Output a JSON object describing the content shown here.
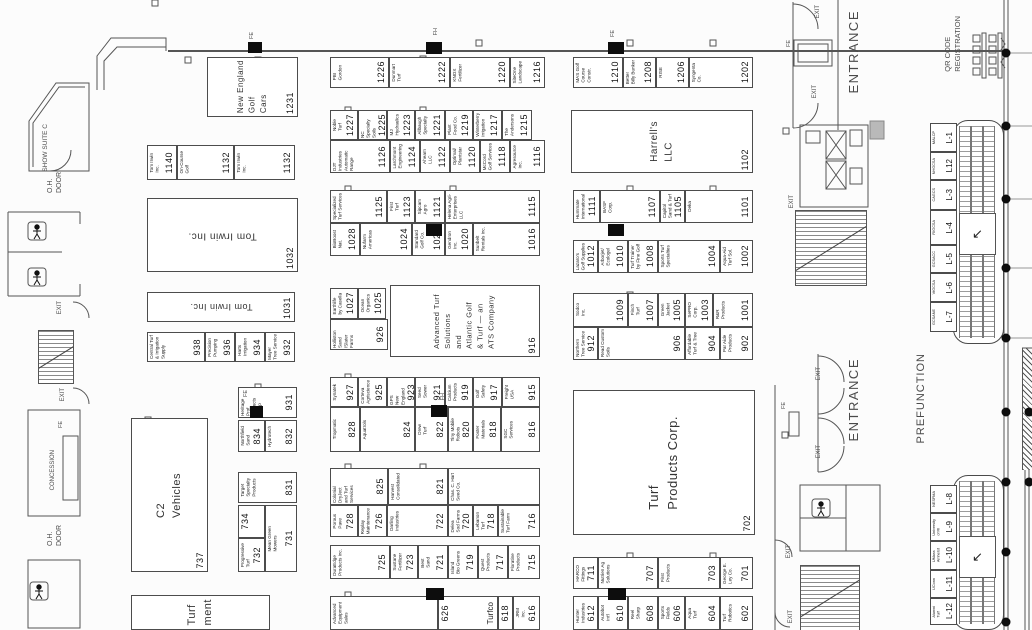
{
  "booths": [
    {
      "n": "1231",
      "t": "New England\nGolf\nCars",
      "x": 207,
      "y": 57,
      "w": 91,
      "h": 60,
      "big": 1,
      "ns": 8
    },
    {
      "n": "1226",
      "t": "PBI\nGordon",
      "x": 330,
      "y": 57,
      "w": 59,
      "h": 31
    },
    {
      "n": "1222",
      "t": "Dunmart\nTurf",
      "x": 389,
      "y": 57,
      "w": 61,
      "h": 31
    },
    {
      "n": "1220",
      "t": "KNOX\nFertilizer",
      "x": 450,
      "y": 57,
      "w": 60,
      "h": 31
    },
    {
      "n": "1216",
      "t": "SiteOne\nLandscape",
      "x": 510,
      "y": 57,
      "w": 35,
      "h": 31
    },
    {
      "n": "1210",
      "t": "MAS Golf\nCourse\nConstr.",
      "x": 573,
      "y": 57,
      "w": 50,
      "h": 31
    },
    {
      "n": "1208",
      "t": "Better\nBilly Bunker",
      "x": 623,
      "y": 57,
      "w": 33,
      "h": 31
    },
    {
      "n": "1206",
      "t": "RISE",
      "x": 656,
      "y": 57,
      "w": 33,
      "h": 31
    },
    {
      "n": "1202",
      "t": "Syngenta\nCo.",
      "x": 689,
      "y": 57,
      "w": 64,
      "h": 31
    },
    {
      "n": "1140",
      "t": "Tom Irwin\nInc.",
      "x": 147,
      "y": 145,
      "w": 30,
      "h": 35
    },
    {
      "n": "1132",
      "t": "On-Course\nGolf",
      "x": 177,
      "y": 145,
      "w": 57,
      "h": 35
    },
    {
      "n": "1132",
      "t": "Tom Irwin\nInc.",
      "x": 234,
      "y": 145,
      "w": 61,
      "h": 35
    },
    {
      "n": "1032",
      "t": "Tom Irwin Inc.",
      "x": 147,
      "y": 198,
      "w": 151,
      "h": 74,
      "big": 1,
      "flip": 1
    },
    {
      "n": "1031",
      "t": "Tom Irwin Inc.",
      "x": 147,
      "y": 292,
      "w": 148,
      "h": 30,
      "big": 1,
      "flip": 1,
      "ns": 9
    },
    {
      "n": "938",
      "t": "Central Turf\n& Irrigation\nSupply",
      "x": 147,
      "y": 332,
      "w": 58,
      "h": 30
    },
    {
      "n": "936",
      "t": "Precision\nPumping",
      "x": 205,
      "y": 332,
      "w": 30,
      "h": 30
    },
    {
      "n": "934",
      "t": "Harts\nIrrigation",
      "x": 235,
      "y": 332,
      "w": 30,
      "h": 30
    },
    {
      "n": "932",
      "t": "Mayer\nTree Service",
      "x": 265,
      "y": 332,
      "w": 30,
      "h": 30
    },
    {
      "n": "931",
      "t": "Heritage Prof.\nProducts\nGroup",
      "x": 238,
      "y": 387,
      "w": 59,
      "h": 31
    },
    {
      "n": "834",
      "t": "Northfield\nSand",
      "x": 238,
      "y": 420,
      "w": 27,
      "h": 32
    },
    {
      "n": "832",
      "t": "Hydrotech",
      "x": 265,
      "y": 420,
      "w": 32,
      "h": 32
    },
    {
      "n": "831",
      "t": "Target\nSpecialty\nProducts",
      "x": 238,
      "y": 472,
      "w": 59,
      "h": 31
    },
    {
      "n": "734",
      "t": "",
      "x": 238,
      "y": 505,
      "w": 27,
      "h": 33
    },
    {
      "n": "732",
      "t": "Progressive\nTurf",
      "x": 238,
      "y": 538,
      "w": 27,
      "h": 34
    },
    {
      "n": "731",
      "t": "Mean Green\nMowers",
      "x": 265,
      "y": 505,
      "w": 32,
      "h": 67
    },
    {
      "n": "737",
      "t": "C2\nVehicles",
      "x": 131,
      "y": 418,
      "w": 77,
      "h": 154,
      "big": 1,
      "ns": 11
    },
    {
      "n": "",
      "t": "Turf\nment",
      "x": 131,
      "y": 595,
      "w": 139,
      "h": 35,
      "big": 1,
      "ns": 11
    },
    {
      "n": "1227",
      "t": "Noble\nTurf",
      "x": 330,
      "y": 110,
      "w": 28,
      "h": 30
    },
    {
      "n": "1225",
      "t": "NC Specialty\nSoils",
      "x": 358,
      "y": 110,
      "w": 29,
      "h": 30
    },
    {
      "n": "1223",
      "t": "MJ\nHydraulics",
      "x": 387,
      "y": 110,
      "w": 28,
      "h": 30
    },
    {
      "n": "1221",
      "t": "Allbaugh\nSpecialty",
      "x": 415,
      "y": 110,
      "w": 30,
      "h": 30
    },
    {
      "n": "1219",
      "t": "Plant\nFood Co.",
      "x": 445,
      "y": 110,
      "w": 28,
      "h": 30
    },
    {
      "n": "1217",
      "t": "Winterberry\nIrrigation",
      "x": 473,
      "y": 110,
      "w": 29,
      "h": 30
    },
    {
      "n": "1215",
      "t": "The\nAndersons",
      "x": 502,
      "y": 110,
      "w": 30,
      "h": 30
    },
    {
      "n": "1126",
      "t": "DJT Industries\nAutomatic Range",
      "x": 330,
      "y": 140,
      "w": 60,
      "h": 33
    },
    {
      "n": "1124",
      "t": "Larchmont\nEngineering",
      "x": 390,
      "y": 140,
      "w": 30,
      "h": 33
    },
    {
      "n": "1122",
      "t": "Ahearn\nLLC",
      "x": 420,
      "y": 140,
      "w": 30,
      "h": 33
    },
    {
      "n": "1120",
      "t": "Optimal/\nPlantstar",
      "x": 450,
      "y": 140,
      "w": 30,
      "h": 33
    },
    {
      "n": "1118",
      "t": "McCord\nGolf Services",
      "x": 480,
      "y": 140,
      "w": 30,
      "h": 33
    },
    {
      "n": "1116",
      "t": "Agresource\nInc.",
      "x": 510,
      "y": 140,
      "w": 35,
      "h": 33
    },
    {
      "n": "1125",
      "t": "Specialized\nTurf Services",
      "x": 330,
      "y": 190,
      "w": 57,
      "h": 33
    },
    {
      "n": "1123",
      "t": "First\nTurf",
      "x": 387,
      "y": 190,
      "w": 28,
      "h": 33
    },
    {
      "n": "1121",
      "t": "Sipcam\nAgro",
      "x": 415,
      "y": 190,
      "w": 30,
      "h": 33
    },
    {
      "n": "1115",
      "t": "Helena Agri-\nEnterprises\nLLC",
      "x": 445,
      "y": 190,
      "w": 95,
      "h": 33
    },
    {
      "n": "1028",
      "t": "BioBoost\nNat.",
      "x": 330,
      "y": 223,
      "w": 30,
      "h": 33
    },
    {
      "n": "1024",
      "t": "Nufarm\nAmericas",
      "x": 360,
      "y": 223,
      "w": 52,
      "h": 33
    },
    {
      "n": "1022",
      "t": "Standard\nGolf Co.",
      "x": 412,
      "y": 223,
      "w": 33,
      "h": 33
    },
    {
      "n": "1020",
      "t": "Gendron\nInc.",
      "x": 445,
      "y": 223,
      "w": 28,
      "h": 33
    },
    {
      "n": "1016",
      "t": "Sunbelt\nRentals Inc.",
      "x": 473,
      "y": 223,
      "w": 67,
      "h": 33
    },
    {
      "n": "1027",
      "t": "Earthlife\nby Casella",
      "x": 330,
      "y": 288,
      "w": 28,
      "h": 31
    },
    {
      "n": "1025",
      "t": "Ocean\nOrganics",
      "x": 358,
      "y": 288,
      "w": 28,
      "h": 31
    },
    {
      "n": "926",
      "t": "Holliston Sand\n/Slater Farms",
      "x": 330,
      "y": 319,
      "w": 58,
      "h": 31
    },
    {
      "n": "916",
      "t": "Advanced Turf\nSolutions\nand\nAtlantic Golf\n& Turf — an\nATS Company",
      "x": 390,
      "y": 285,
      "w": 150,
      "h": 72,
      "big": 1,
      "ns": 7.5
    },
    {
      "n": "927",
      "t": "Synatek",
      "x": 330,
      "y": 377,
      "w": 28,
      "h": 30
    },
    {
      "n": "925",
      "t": "Corteva\nAgriscience",
      "x": 358,
      "y": 377,
      "w": 29,
      "h": 30
    },
    {
      "n": "923",
      "t": "GPS\nNew England",
      "x": 387,
      "y": 377,
      "w": 28,
      "h": 30
    },
    {
      "n": "921",
      "t": "Seed\nSower",
      "x": 415,
      "y": 377,
      "w": 30,
      "h": 30
    },
    {
      "n": "919",
      "t": "Calcium\nProducts",
      "x": 445,
      "y": 377,
      "w": 28,
      "h": 30
    },
    {
      "n": "917",
      "t": "Golf\nSafety",
      "x": 473,
      "y": 377,
      "w": 29,
      "h": 30
    },
    {
      "n": "915",
      "t": "Freight\nUSA",
      "x": 502,
      "y": 377,
      "w": 38,
      "h": 30
    },
    {
      "n": "828",
      "t": "Tropmatic",
      "x": 330,
      "y": 407,
      "w": 30,
      "h": 45
    },
    {
      "n": "824",
      "t": "Aquatrols",
      "x": 360,
      "y": 407,
      "w": 55,
      "h": 45
    },
    {
      "n": "822",
      "t": "Drew\nTurf",
      "x": 415,
      "y": 407,
      "w": 33,
      "h": 45
    },
    {
      "n": "820",
      "t": "Tiny Mobile\nRobots",
      "x": 448,
      "y": 407,
      "w": 25,
      "h": 45
    },
    {
      "n": "818",
      "t": "Foster\nMaterials",
      "x": 473,
      "y": 407,
      "w": 28,
      "h": 45
    },
    {
      "n": "816",
      "t": "SGC\nServices",
      "x": 501,
      "y": 407,
      "w": 39,
      "h": 45
    },
    {
      "n": "825",
      "t": "Colonial DryJect\nand Turf\nServices",
      "x": 330,
      "y": 468,
      "w": 58,
      "h": 37
    },
    {
      "n": "821",
      "t": "Harvest\nConsolidated",
      "x": 388,
      "y": 468,
      "w": 60,
      "h": 37
    },
    {
      "n": "",
      "t": "Chas. C. Hart\nSeed Co.",
      "x": 448,
      "y": 468,
      "w": 92,
      "h": 37
    },
    {
      "n": "728",
      "t": "Porous\nPave",
      "x": 330,
      "y": 505,
      "w": 28,
      "h": 32
    },
    {
      "n": "726",
      "t": "Replay\nMaintenance",
      "x": 358,
      "y": 505,
      "w": 29,
      "h": 32
    },
    {
      "n": "722",
      "t": "Darling\nIndustries",
      "x": 387,
      "y": 505,
      "w": 61,
      "h": 32
    },
    {
      "n": "720",
      "t": "Delea\nSod Farms",
      "x": 448,
      "y": 505,
      "w": 25,
      "h": 32
    },
    {
      "n": "718",
      "t": "Lebanon\nTurf",
      "x": 473,
      "y": 505,
      "w": 25,
      "h": 32
    },
    {
      "n": "716",
      "t": "Sustainable\nTurf Farm",
      "x": 498,
      "y": 505,
      "w": 42,
      "h": 32
    },
    {
      "n": "725",
      "t": "DuraEdge\nProducts Inc.",
      "x": 330,
      "y": 545,
      "w": 60,
      "h": 34
    },
    {
      "n": "723",
      "t": "Sustane\nFertilizer",
      "x": 390,
      "y": 545,
      "w": 28,
      "h": 34
    },
    {
      "n": "721",
      "t": "Best\nSand",
      "x": 418,
      "y": 545,
      "w": 30,
      "h": 34
    },
    {
      "n": "719",
      "t": "Island\nBio Greens",
      "x": 448,
      "y": 545,
      "w": 30,
      "h": 34
    },
    {
      "n": "717",
      "t": "Quest\nProducts",
      "x": 478,
      "y": 545,
      "w": 30,
      "h": 34
    },
    {
      "n": "715",
      "t": "Floratine\nProducts",
      "x": 508,
      "y": 545,
      "w": 32,
      "h": 34
    },
    {
      "n": "",
      "t": "Advanced\nEquipment\nSales",
      "x": 330,
      "y": 596,
      "w": 108,
      "h": 34
    },
    {
      "n": "626",
      "t": "Turfco",
      "x": 438,
      "y": 596,
      "w": 60,
      "h": 34,
      "rev": 1,
      "ns": 8
    },
    {
      "n": "618",
      "t": "",
      "x": 498,
      "y": 596,
      "w": 15,
      "h": 34
    },
    {
      "n": "616",
      "t": "JRM\nInc.",
      "x": 513,
      "y": 596,
      "w": 27,
      "h": 34
    },
    {
      "n": "1102",
      "t": "Harrell's\nLLC",
      "x": 571,
      "y": 110,
      "w": 182,
      "h": 63,
      "big": 1
    },
    {
      "n": "1111",
      "t": "Hummate\nInternational",
      "x": 573,
      "y": 190,
      "w": 27,
      "h": 33
    },
    {
      "n": "1107",
      "t": "BASF\nCorp.",
      "x": 600,
      "y": 190,
      "w": 60,
      "h": 33
    },
    {
      "n": "1105",
      "t": "Capitol\nSand & Turf",
      "x": 660,
      "y": 190,
      "w": 25,
      "h": 33
    },
    {
      "n": "1101",
      "t": "Deka",
      "x": 685,
      "y": 190,
      "w": 68,
      "h": 33
    },
    {
      "n": "1012",
      "t": "Lazaro's\nGolf Supplies",
      "x": 573,
      "y": 240,
      "w": 25,
      "h": 33
    },
    {
      "n": "1010",
      "t": "Arborjet/\nEcologel",
      "x": 598,
      "y": 240,
      "w": 30,
      "h": 33
    },
    {
      "n": "1008",
      "t": "Turf Trainer\nby Fine Golf",
      "x": 628,
      "y": 240,
      "w": 30,
      "h": 33
    },
    {
      "n": "1004",
      "t": "Sports Turf\nSpecialties",
      "x": 658,
      "y": 240,
      "w": 62,
      "h": 33
    },
    {
      "n": "1002",
      "t": "Aqua-Aid\nTurf Sol.",
      "x": 720,
      "y": 240,
      "w": 33,
      "h": 33
    },
    {
      "n": "1009",
      "t": "Sodco\nInc.",
      "x": 573,
      "y": 293,
      "w": 55,
      "h": 34
    },
    {
      "n": "1007",
      "t": "Finch\nTurf",
      "x": 628,
      "y": 293,
      "w": 30,
      "h": 34
    },
    {
      "n": "1005",
      "t": "Green\nJacket",
      "x": 658,
      "y": 293,
      "w": 27,
      "h": 34
    },
    {
      "n": "1003",
      "t": "SePRO\nCorp.",
      "x": 685,
      "y": 293,
      "w": 28,
      "h": 34
    },
    {
      "n": "1001",
      "t": "R&R\nProducts",
      "x": 713,
      "y": 293,
      "w": 40,
      "h": 34
    },
    {
      "n": "912",
      "t": "Northern\nTree Service",
      "x": 573,
      "y": 327,
      "w": 25,
      "h": 33
    },
    {
      "n": "906",
      "t": "Read Custom\nSoils",
      "x": 598,
      "y": 327,
      "w": 87,
      "h": 33
    },
    {
      "n": "904",
      "t": "Affordable\nTurf & Tree",
      "x": 685,
      "y": 327,
      "w": 35,
      "h": 33
    },
    {
      "n": "902",
      "t": "Par Aide\nProducts",
      "x": 720,
      "y": 327,
      "w": 33,
      "h": 33
    },
    {
      "n": "702",
      "t": "Turf\nProducts Corp.",
      "x": 573,
      "y": 390,
      "w": 182,
      "h": 145,
      "big": 1,
      "ns": 13
    },
    {
      "n": "711",
      "t": "HARCO\nFittings",
      "x": 573,
      "y": 557,
      "w": 25,
      "h": 32
    },
    {
      "n": "707",
      "t": "Nutrien Ag\nSolutions",
      "x": 598,
      "y": 557,
      "w": 60,
      "h": 32
    },
    {
      "n": "703",
      "t": "First\nProducts",
      "x": 658,
      "y": 557,
      "w": 62,
      "h": 32
    },
    {
      "n": "701",
      "t": "George E.\nLey Co.",
      "x": 720,
      "y": 557,
      "w": 33,
      "h": 32
    },
    {
      "n": "612",
      "t": "Hunter\nIndustries",
      "x": 573,
      "y": 596,
      "w": 25,
      "h": 34
    },
    {
      "n": "610",
      "t": "Autobot\nInt'l",
      "x": 598,
      "y": 596,
      "w": 30,
      "h": 34
    },
    {
      "n": "608",
      "t": "Reel\nSharp",
      "x": 628,
      "y": 596,
      "w": 30,
      "h": 34
    },
    {
      "n": "606",
      "t": "Sports\nFields",
      "x": 658,
      "y": 596,
      "w": 27,
      "h": 34
    },
    {
      "n": "604",
      "t": "Aqua\nTurf",
      "x": 685,
      "y": 596,
      "w": 35,
      "h": 34
    },
    {
      "n": "602",
      "t": "Turf\nRobotics",
      "x": 720,
      "y": 596,
      "w": 33,
      "h": 34
    },
    {
      "n": "L-1",
      "t": "MALCP",
      "x": 930,
      "y": 123,
      "w": 27,
      "h": 29,
      "cls": "lcell"
    },
    {
      "n": "L12",
      "t": "NHGCSA",
      "x": 930,
      "y": 152,
      "w": 27,
      "h": 28,
      "cls": "lcell"
    },
    {
      "n": "L-3",
      "t": "CAGCS",
      "x": 930,
      "y": 180,
      "w": 27,
      "h": 30,
      "cls": "lcell"
    },
    {
      "n": "L-4",
      "t": "RIGCSA",
      "x": 930,
      "y": 210,
      "w": 27,
      "h": 35,
      "cls": "lcell"
    },
    {
      "n": "L-5",
      "t": "GCSACC",
      "x": 930,
      "y": 245,
      "w": 27,
      "h": 28,
      "cls": "lcell"
    },
    {
      "n": "L-6",
      "t": "VtGCSA",
      "x": 930,
      "y": 273,
      "w": 27,
      "h": 29,
      "cls": "lcell"
    },
    {
      "n": "L-7",
      "t": "GCSANE",
      "x": 930,
      "y": 302,
      "w": 27,
      "h": 30,
      "cls": "lcell"
    },
    {
      "n": "L-8",
      "t": "NESFMA",
      "x": 930,
      "y": 485,
      "w": 27,
      "h": 28,
      "cls": "lcell"
    },
    {
      "n": "L-9",
      "t": "University\nof RI",
      "x": 930,
      "y": 513,
      "w": 27,
      "h": 28,
      "cls": "lcell"
    },
    {
      "n": "L-10",
      "t": "UMass\nAmherst",
      "x": 930,
      "y": 541,
      "w": 27,
      "h": 29,
      "cls": "lcell"
    },
    {
      "n": "L-11",
      "t": "UConn",
      "x": 930,
      "y": 570,
      "w": 27,
      "h": 28,
      "cls": "lcell"
    },
    {
      "n": "L-12",
      "t": "Alumni\nTurf",
      "x": 930,
      "y": 598,
      "w": 27,
      "h": 27,
      "cls": "lcell"
    }
  ],
  "labels": [
    {
      "t": "SHOW SUITE C",
      "x": 42,
      "y": 124,
      "s": 6.5
    },
    {
      "t": "O.H.\nDOOR",
      "x": 46,
      "y": 172,
      "s": 7
    },
    {
      "t": "O.H.\nDOOR",
      "x": 46,
      "y": 525,
      "s": 7
    },
    {
      "t": "CONCESSION",
      "x": 50,
      "y": 450,
      "s": 6
    },
    {
      "t": "PREFUNCTION",
      "x": 914,
      "y": 353,
      "s": 11,
      "ls": 1
    },
    {
      "t": "ENTRANCE",
      "x": 846,
      "y": 10,
      "s": 13,
      "ls": 1.5
    },
    {
      "t": "ENTRANCE",
      "x": 846,
      "y": 358,
      "s": 13,
      "ls": 1.5
    },
    {
      "t": "QR CODE\nREGISTRATION",
      "x": 943,
      "y": 16,
      "s": 7.5
    },
    {
      "t": "EXIT",
      "x": 57,
      "y": 301,
      "s": 6
    },
    {
      "t": "EXIT",
      "x": 60,
      "y": 388,
      "s": 6
    },
    {
      "t": "EXIT",
      "x": 815,
      "y": 5,
      "s": 6
    },
    {
      "t": "EXIT",
      "x": 812,
      "y": 85,
      "s": 6
    },
    {
      "t": "EXIT",
      "x": 789,
      "y": 195,
      "s": 6
    },
    {
      "t": "EXIT",
      "x": 816,
      "y": 367,
      "s": 6
    },
    {
      "t": "EXIT",
      "x": 816,
      "y": 445,
      "s": 6
    },
    {
      "t": "EXIT",
      "x": 786,
      "y": 545,
      "s": 6
    },
    {
      "t": "EXIT",
      "x": 788,
      "y": 610,
      "s": 6
    },
    {
      "t": "FE",
      "x": 249,
      "y": 32,
      "s": 5.5
    },
    {
      "t": "FE",
      "x": 610,
      "y": 30,
      "s": 5.5
    },
    {
      "t": "FE",
      "x": 786,
      "y": 40,
      "s": 5.5
    },
    {
      "t": "FE",
      "x": 58,
      "y": 421,
      "s": 5.5
    },
    {
      "t": "FE",
      "x": 243,
      "y": 390,
      "s": 5.5
    },
    {
      "t": "FE",
      "x": 781,
      "y": 402,
      "s": 5.5
    },
    {
      "t": "FH",
      "x": 433,
      "y": 28,
      "s": 5.5
    },
    {
      "t": "FH",
      "x": 440,
      "y": 393,
      "s": 5.5
    }
  ],
  "markers": [
    [
      248,
      42,
      14,
      11
    ],
    [
      426,
      42,
      16,
      12
    ],
    [
      608,
      42,
      16,
      12
    ],
    [
      426,
      224,
      16,
      12
    ],
    [
      608,
      224,
      16,
      12
    ],
    [
      250,
      406,
      13,
      12
    ],
    [
      431,
      405,
      16,
      12
    ],
    [
      426,
      588,
      18,
      12
    ],
    [
      608,
      588,
      18,
      12
    ]
  ],
  "dots": [
    [
      1006,
      53
    ],
    [
      1006,
      126
    ],
    [
      1006,
      199
    ],
    [
      1006,
      268
    ],
    [
      1006,
      338
    ],
    [
      1006,
      412
    ],
    [
      1006,
      482
    ],
    [
      1006,
      552
    ],
    [
      1006,
      622
    ],
    [
      1029,
      412
    ],
    [
      1029,
      482
    ]
  ],
  "escalators": {
    "arrow": "↙"
  },
  "colors": {
    "line": "#555555",
    "booth_border": "#4c4c4c",
    "marker": "#0d0d0d",
    "background": "#fcfcfc"
  }
}
